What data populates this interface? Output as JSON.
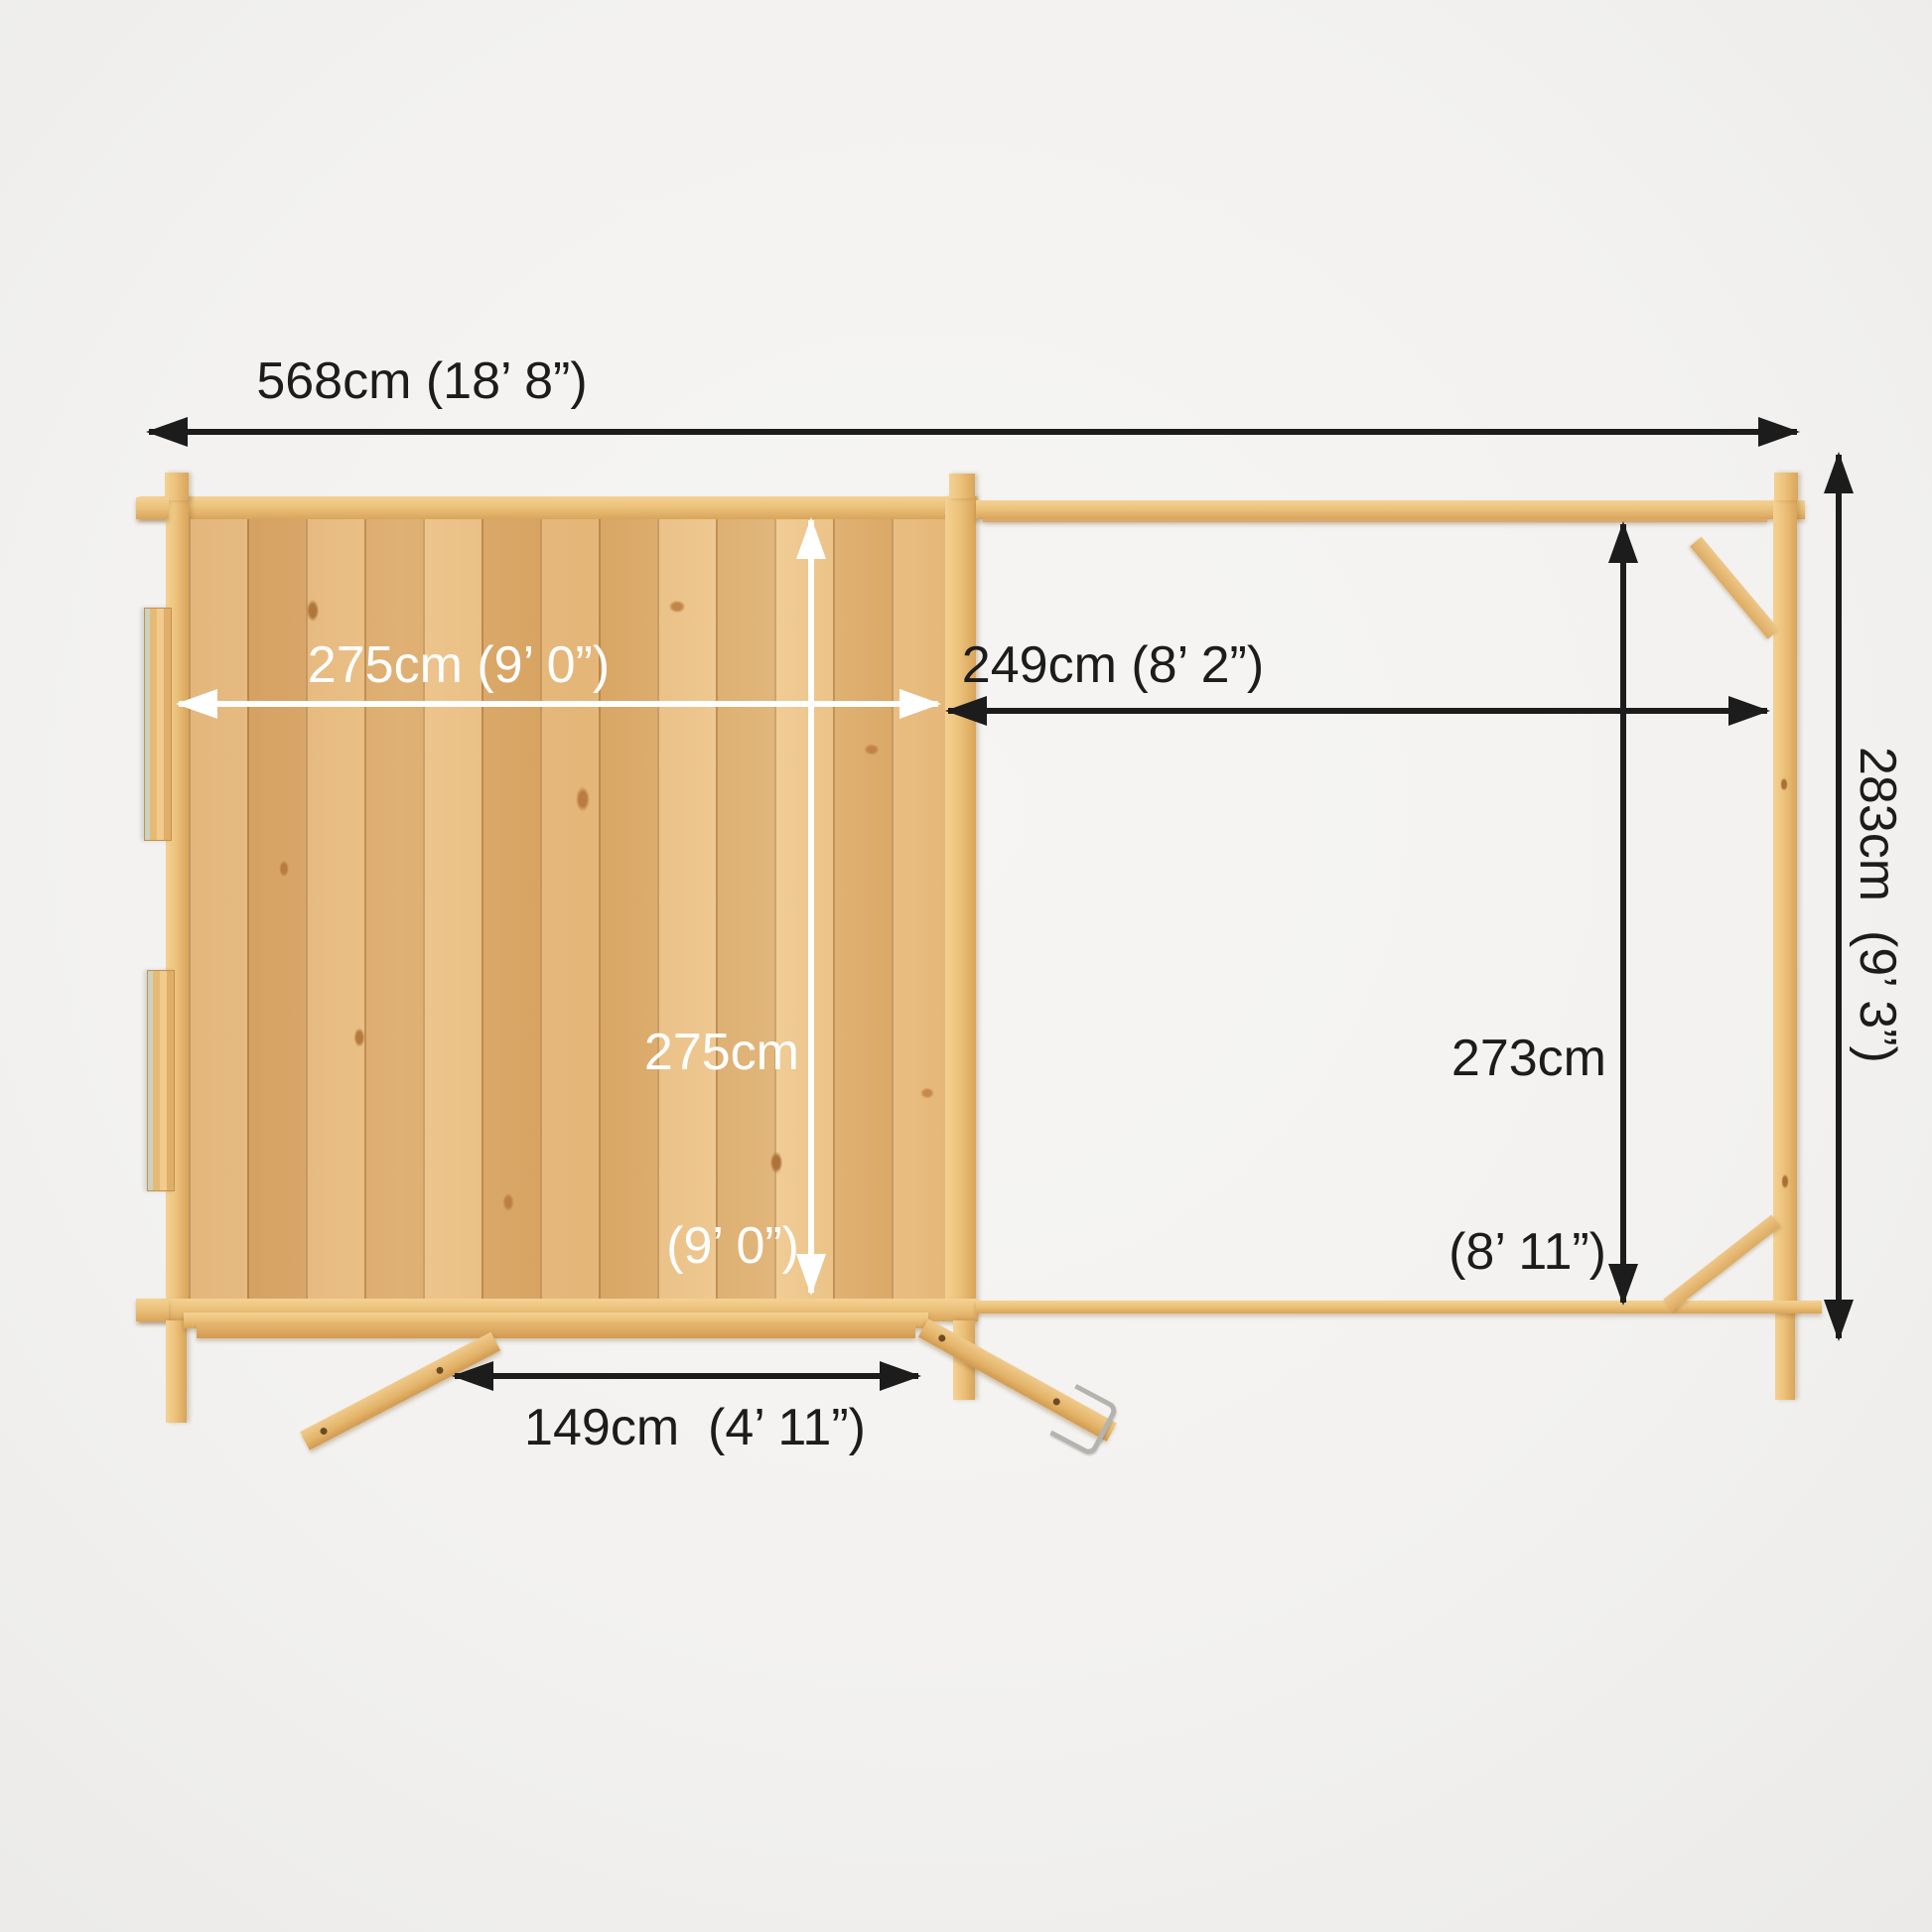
{
  "diagram": {
    "type": "top-view-dimension-diagram",
    "subject": "Log cabin with side canopy, viewed from above with internal and external dimensions",
    "background_color": "#f3f2f0",
    "wood_color": "#ecc27b",
    "external_dimension_color": "#1c1c1c",
    "internal_dimension_color": "#ffffff"
  },
  "measurements": {
    "overall_width": "568cm (18’ 8”)",
    "cabin_width": "275cm (9’ 0”)",
    "cabin_depth": {
      "line1": "275cm",
      "line2": "(9’ 0”)"
    },
    "canopy_width": "249cm (8’ 2”)",
    "canopy_depth": {
      "line1": "273cm",
      "line2": "(8’ 11”)"
    },
    "overall_depth": "283cm  (9’ 3”)",
    "door_width": "149cm  (4’ 11”)"
  }
}
